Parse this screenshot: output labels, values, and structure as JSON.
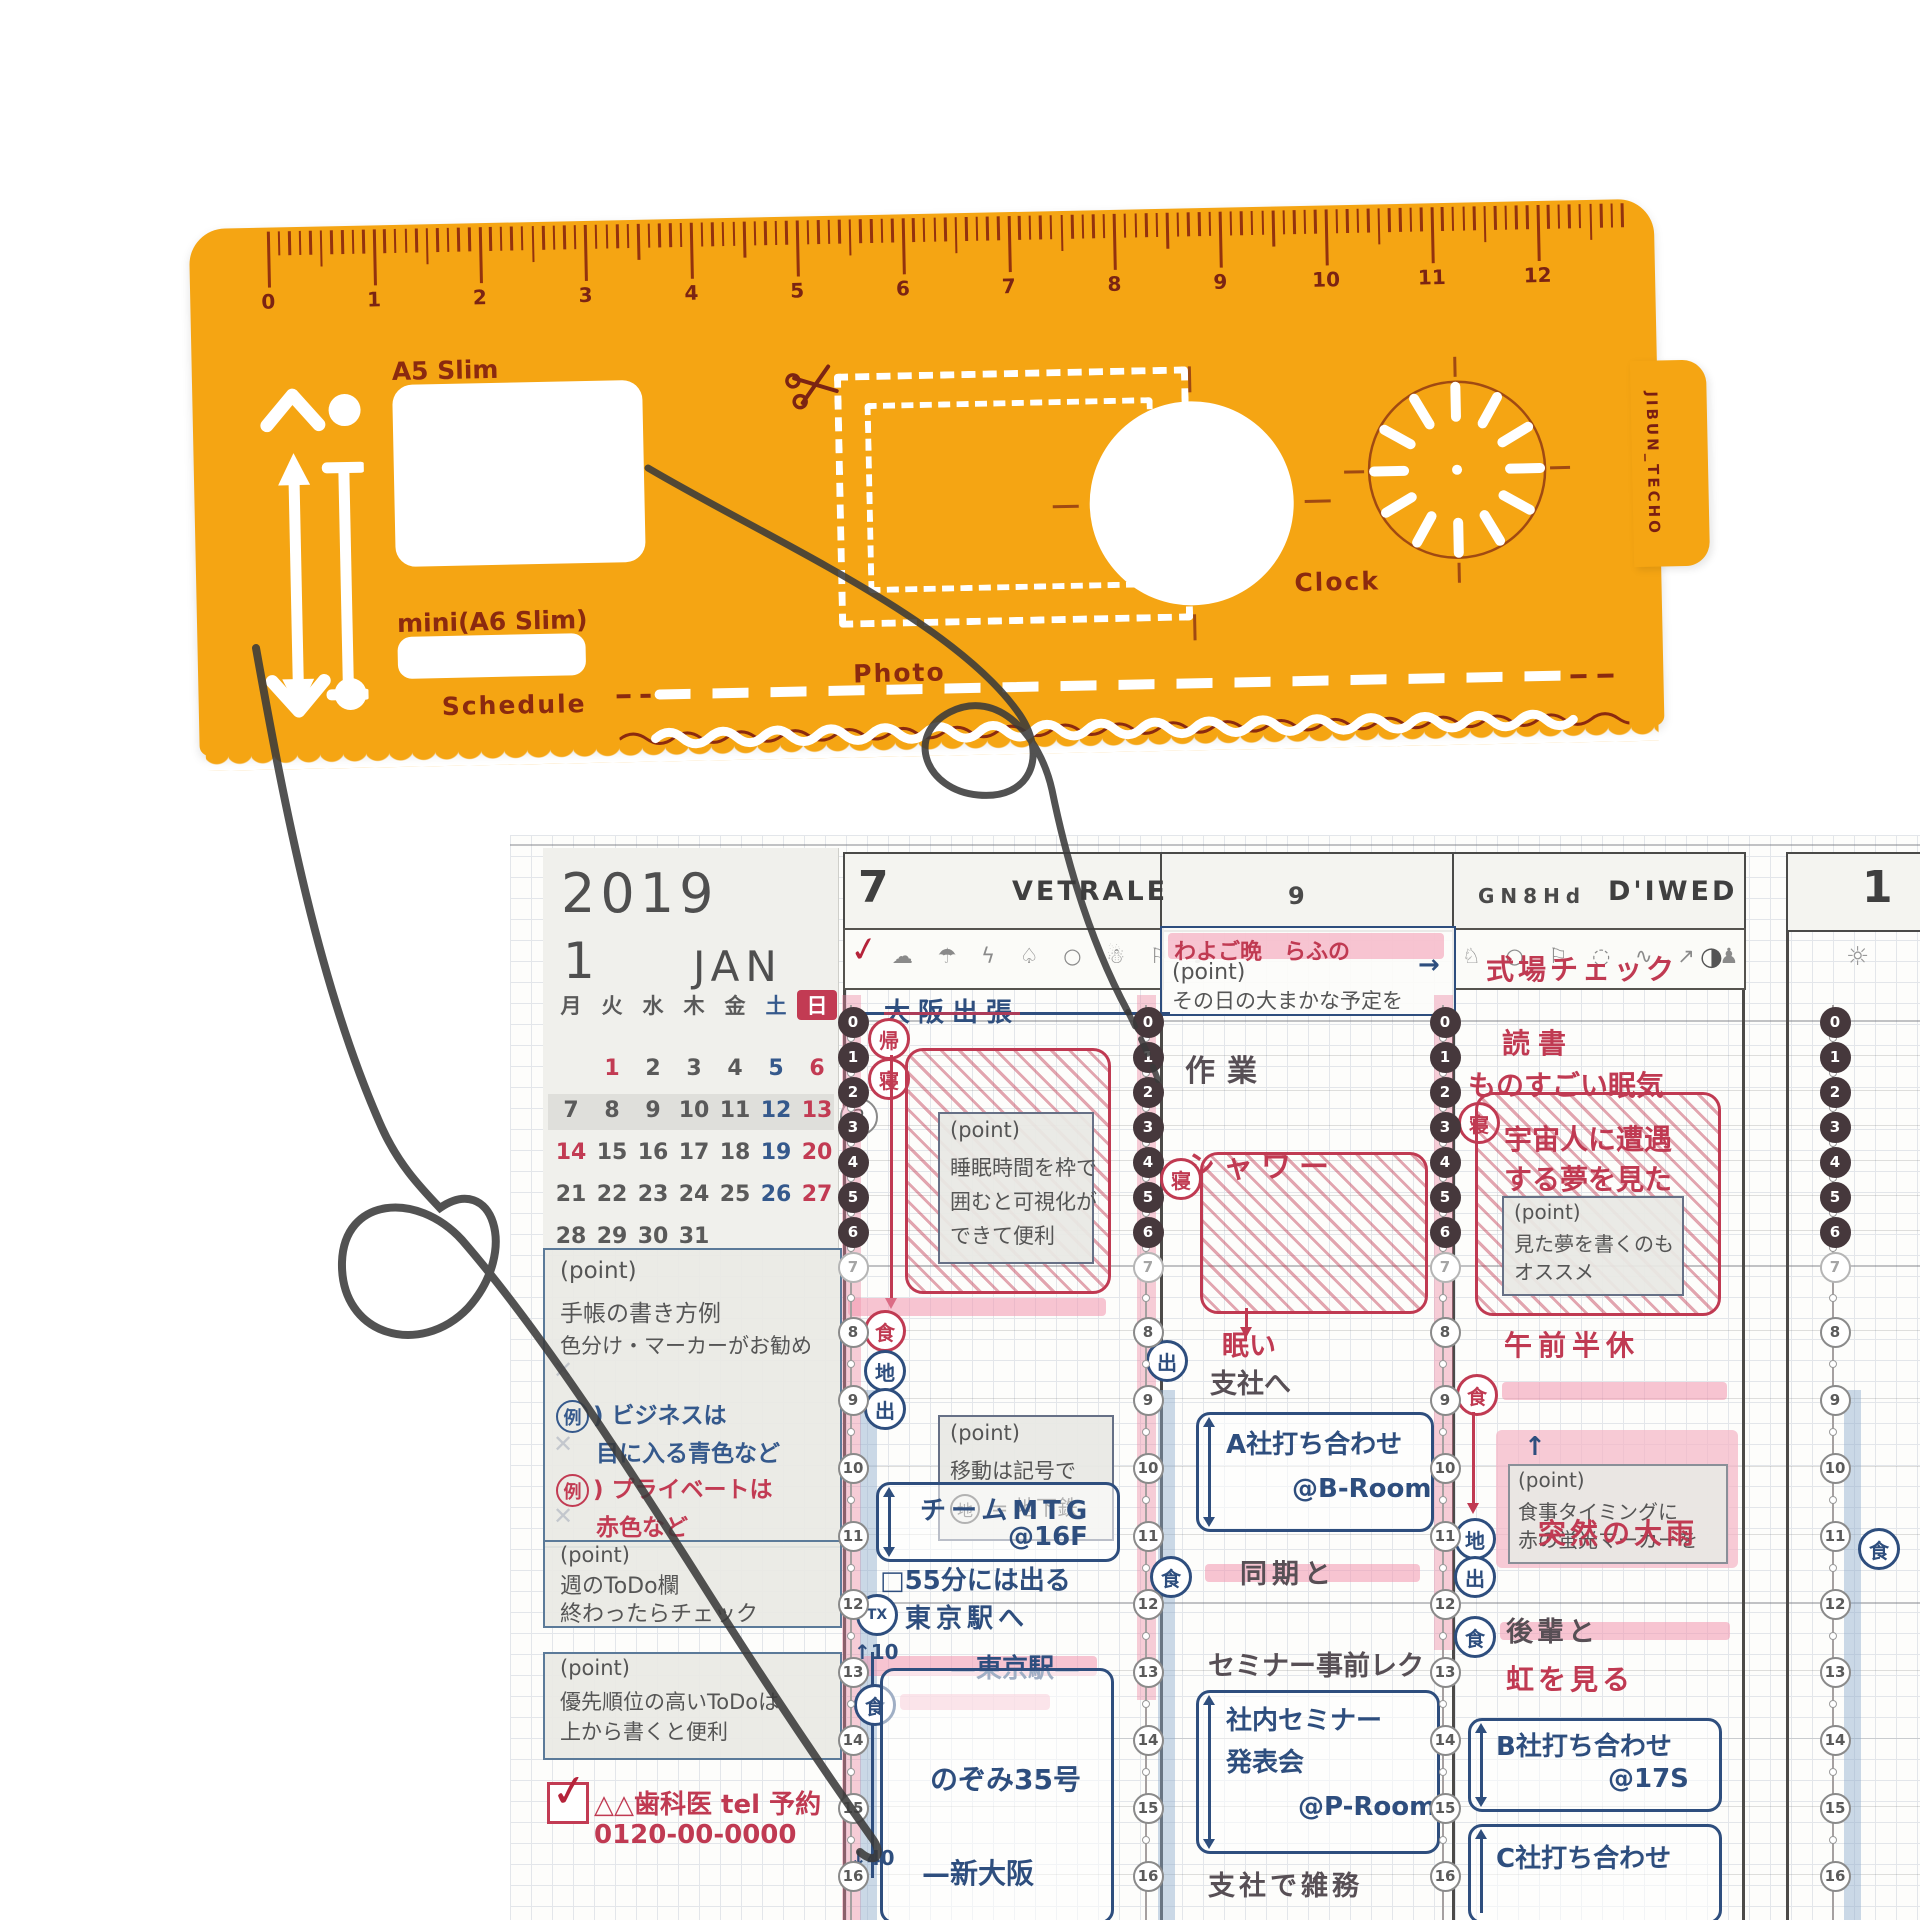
{
  "colors": {
    "stencil_orange": "#F5A513",
    "engrave_red": "#8B2A0F",
    "planner_red": "#C03A52",
    "planner_navy": "#2E4E7E",
    "highlight_pink": "#F2ADC0",
    "calendar_red": "#C23B53",
    "calendar_blue": "#35598C"
  },
  "stencil": {
    "brand_vertical": "JIBUN_TECHO",
    "ruler_numbers": [
      "0",
      "1",
      "2",
      "3",
      "4",
      "5",
      "6",
      "7",
      "8",
      "9",
      "10",
      "11",
      "12"
    ],
    "labels": {
      "a5": "A5 Slim",
      "a6": "mini(A6 Slim)",
      "schedule": "Schedule",
      "photo": "Photo",
      "clock": "Clock"
    }
  },
  "planner": {
    "calendar": {
      "year": "2019",
      "month": "1",
      "month_abbr": "JAN",
      "weekdays": [
        "月",
        "火",
        "水",
        "木",
        "金",
        "土",
        "日"
      ],
      "weeks": [
        [
          "",
          "1",
          "2",
          "3",
          "4",
          "5",
          "6"
        ],
        [
          "7",
          "8",
          "9",
          "10",
          "11",
          "12",
          "13"
        ],
        [
          "14",
          "15",
          "16",
          "17",
          "18",
          "19",
          "20"
        ],
        [
          "21",
          "22",
          "23",
          "24",
          "25",
          "26",
          "27"
        ],
        [
          "28",
          "29",
          "30",
          "31",
          "",
          "",
          ""
        ]
      ],
      "red_dates": [
        1,
        6,
        13,
        14,
        20,
        27
      ],
      "blue_dates": [
        5,
        12,
        19,
        26
      ],
      "week_badge": "2"
    },
    "sidebar": {
      "box1": {
        "title": "(point)",
        "line1": "手帳の書き方例",
        "line2": "色分け・マーカーがお勧め",
        "ex_mark": "例",
        "ex_paren": ")",
        "ex1a": "ビジネスは",
        "ex1b": "目に入る青色など",
        "ex2a": "プライベートは",
        "ex2b": "赤色など",
        "x_glyph": "✕"
      },
      "box2": {
        "title": "(point)",
        "line1": "週のToDo欄",
        "line2": "終わったらチェック"
      },
      "box3": {
        "title": "(point)",
        "line1": "優先順位の高いToDoは",
        "line2": "上から書くと便利"
      },
      "todo": {
        "check": "✓",
        "text": "△△歯科医 tel 予約",
        "phone": "0120-00-0000"
      }
    },
    "timeline_hours": [
      "0",
      "1",
      "2",
      "3",
      "4",
      "5",
      "6",
      "7",
      "8",
      "9",
      "10",
      "11",
      "12",
      "13",
      "14",
      "15",
      "16"
    ],
    "columns": {
      "col1": {
        "day": "7",
        "name": "VETRALE",
        "weather_check": "✓",
        "weather_icons": "☁ ☂ ϟ ♤ ○ ☃ ⚐ ♪",
        "trip": "大阪出張",
        "arrow_left": "←",
        "badges": {
          "kaeri": "帰",
          "ne": "寝",
          "shoku": "食",
          "chi": "地",
          "de": "出",
          "tx": "TX",
          "shoku2": "食"
        },
        "sleep_note": [
          "(point)",
          "睡眠時間を枠で",
          "囲むと可視化が",
          "できて便利"
        ],
        "move_note_title": "(point)",
        "move_note_line": "移動は記号で",
        "move_badge": "地",
        "move_eq": "= 地下鉄",
        "mtg": [
          "チームMTG",
          "@16F"
        ],
        "leave": "□55分には出る",
        "to_tokyo": "東京駅へ",
        "up10": "↑10",
        "tokyo_sta": "—東京駅—",
        "nozomi": "のぞみ35号",
        "shin_osaka": "—新大阪",
        "down40": "↓40"
      },
      "col2": {
        "day": "9",
        "pink_note_top": "わよご晩　らふの",
        "point_title": "(point)",
        "point_line": "その日の大まかな予定を",
        "work": "作業",
        "shower": "シャワー",
        "ne": "寝",
        "de": "出",
        "shoku": "食",
        "sleepy": "眠い",
        "to_branch": "支社へ",
        "meetingA": [
          "A社打ち合わせ",
          "@B-Room"
        ],
        "douki": "同期と",
        "seminar_pre": "セミナー事前レク",
        "seminar": [
          "社内セミナー",
          "発表会",
          "@P-Room"
        ],
        "branch_work": "支社で雑務"
      },
      "col3": {
        "day_glyphs": "GN8Hd",
        "name": "D'IWED",
        "weather_icons": "♘ ○ ⚐ ◌ ∿ ↗ ♟",
        "moon": "◑",
        "arrow": "→",
        "venue": "式場チェック",
        "reading": "読書",
        "sleepy": "ものすごい眠気",
        "ne": "寝",
        "shoku": "食",
        "chi": "地",
        "de": "出",
        "shoku2": "食",
        "dream": [
          "宇宙人に遭遇",
          "する夢を見た"
        ],
        "dream_note": [
          "(point)",
          "見た夢を書くのも",
          "オススメ"
        ],
        "half_day": "午前半休",
        "meal_note": [
          "↑",
          "(point)",
          "食事タイミングに",
          "赤の蛍光マーカーを"
        ],
        "rain": "突然の大雨",
        "kouhai": "後輩と",
        "rainbow": "虹を見る",
        "meetingB": [
          "B社打ち合わせ",
          "@17S"
        ],
        "meetingC": "C社打ち合わせ"
      },
      "col4": {
        "day": "1",
        "sun": "☼",
        "shoku": "食"
      }
    }
  }
}
